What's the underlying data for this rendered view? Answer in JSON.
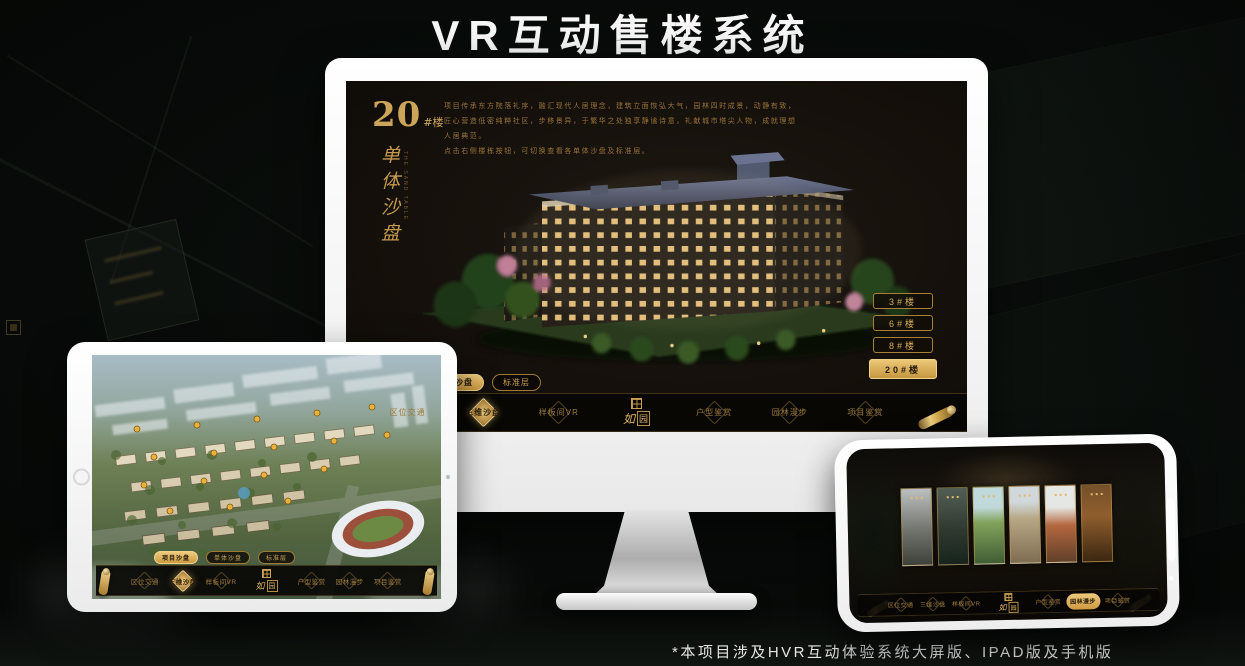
{
  "page": {
    "title": "VR互动售楼系统",
    "footnote": "*本项目涉及HVR互动体验系统大屏版、IPAD版及手机版"
  },
  "colors": {
    "accent_gold": "#cda55a",
    "accent_gold_bright": "#eeca7c",
    "screen_background": "#15100b",
    "navbar_background": "#080604",
    "active_text": "#241a0c",
    "device_frame": "#ffffff"
  },
  "monitor": {
    "building_no": "20",
    "building_no_suffix": "#楼",
    "section_title": "单体沙盘",
    "section_title_en": "THE SAND TABLE",
    "description_lines": [
      "项目传承东方院落礼序，融汇现代人居理念，建筑立面恢弘大气，园林四时成景，动静有致，",
      "匠心营造低密纯粹社区，步移景异，于繁华之处独享静谧诗意，礼献城市塔尖人物，成就理想",
      "人居典范。",
      "点击右侧楼栋按钮，可切换查看各单体沙盘及标准层。"
    ],
    "floor_buttons": [
      {
        "label": "3#楼",
        "active": false
      },
      {
        "label": "6#楼",
        "active": false
      },
      {
        "label": "8#楼",
        "active": false
      },
      {
        "label": "20#楼",
        "active": true
      }
    ],
    "sub_tabs": [
      {
        "label": "项目沙盘",
        "active": false
      },
      {
        "label": "单体沙盘",
        "active": true
      },
      {
        "label": "标准层",
        "active": false
      }
    ],
    "nav": {
      "items": [
        "区位交通",
        "三维沙盘",
        "样板间VR",
        "户型鉴赏",
        "园林漫步",
        "项目鉴赏"
      ],
      "active_index": 1,
      "logo_script": "如",
      "logo_boxed": "园"
    }
  },
  "tablet": {
    "sub_tabs": [
      {
        "label": "项目沙盘",
        "active": true
      },
      {
        "label": "单体沙盘",
        "active": false
      },
      {
        "label": "标准层",
        "active": false
      }
    ],
    "nav": {
      "items": [
        "区位交通",
        "三维沙盘",
        "样板间VR",
        "户型鉴赏",
        "园林漫步",
        "项目鉴赏"
      ],
      "active_index": 1,
      "logo_script": "如",
      "logo_boxed": "园"
    }
  },
  "phone": {
    "nav": {
      "items": [
        "区位交通",
        "三维沙盘",
        "样板间VR",
        "户型鉴赏",
        "园林漫步",
        "项目鉴赏"
      ],
      "active_index": 4,
      "logo_script": "如",
      "logo_boxed": "园"
    },
    "gallery_panel_count": 6
  }
}
